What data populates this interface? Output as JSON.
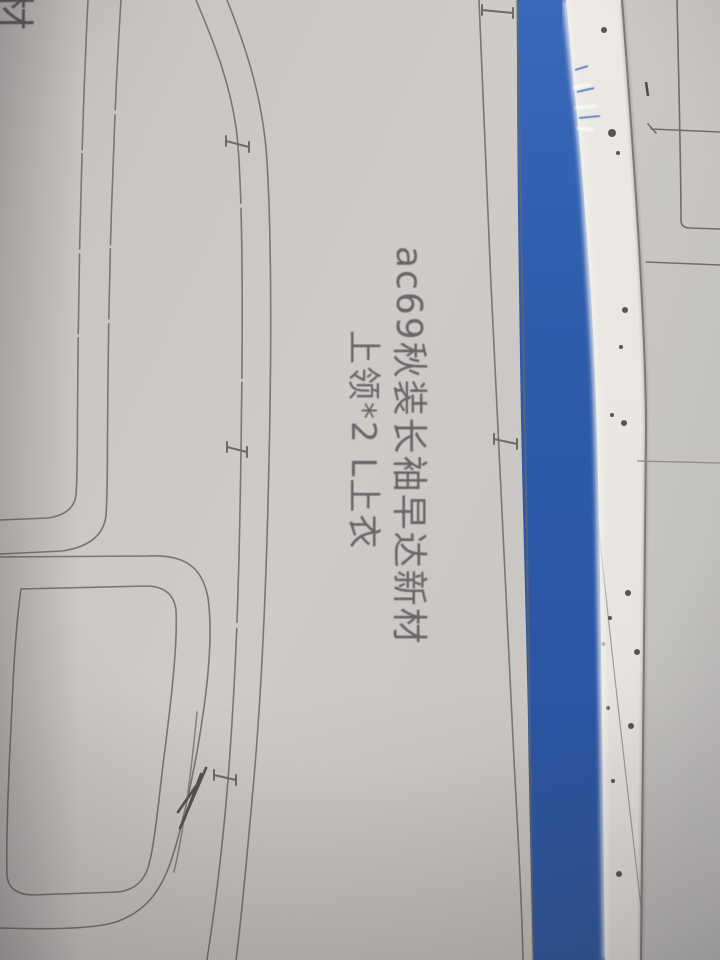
{
  "photo": {
    "annotation": {
      "line1": "ac69秋装长袖早达新材",
      "line2": "上领*2 L上衣",
      "corner_partial": "材"
    },
    "colors": {
      "paper_left": "#c9c6c3",
      "paper_white_strip": "#eae7e2",
      "paper_right": "#c6c4c1",
      "tape_blue": "#2e5cab",
      "pencil_line": "#7b7672",
      "marker_text": "#57535a",
      "ink_speckle": "#3d3a38"
    },
    "speckles": [
      [
        604,
        30,
        3
      ],
      [
        612,
        133,
        4
      ],
      [
        618,
        153,
        2
      ],
      [
        648,
        89,
        2
      ],
      [
        625,
        310,
        3
      ],
      [
        621,
        347,
        2
      ],
      [
        612,
        415,
        2
      ],
      [
        624,
        423,
        3
      ],
      [
        628,
        593,
        3
      ],
      [
        610,
        618,
        2
      ],
      [
        603,
        644,
        2
      ],
      [
        637,
        652,
        3
      ],
      [
        608,
        708,
        2
      ],
      [
        631,
        726,
        3
      ],
      [
        613,
        781,
        2
      ],
      [
        619,
        874,
        3
      ],
      [
        598,
        940,
        3
      ]
    ]
  }
}
